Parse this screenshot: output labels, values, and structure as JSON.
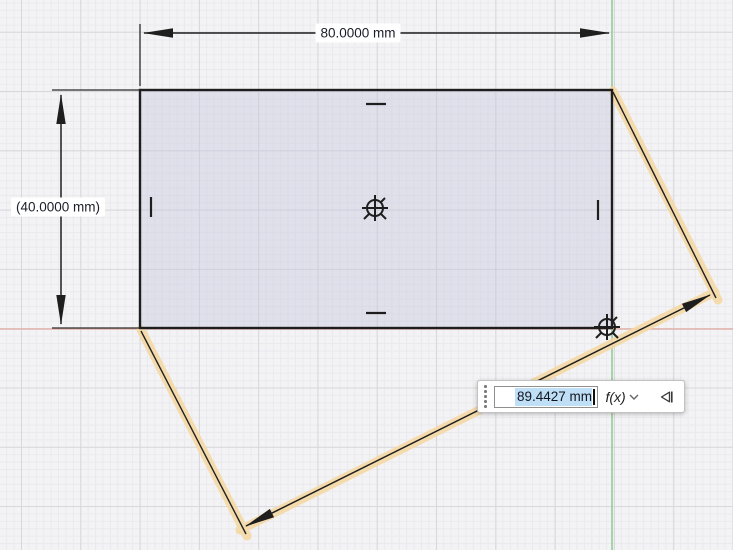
{
  "canvas": {
    "top_dimension_label": "80.0000 mm",
    "left_dimension_label": "(40.0000 mm)"
  },
  "dimension_input": {
    "value": "89.4427 mm",
    "fx_label": "f(x)"
  },
  "colors": {
    "x_axis_red": "#e4b3ac",
    "y_axis_green": "#95cb95",
    "sketch_line_black": "#1e1e1e",
    "profile_fill": "#e2e3ec",
    "selection_highlight_blue": "#bedff6",
    "dimension_glow_orange": "#f5d9a5",
    "grid_major": "#d7d7dc",
    "grid_minor": "#eaeaee"
  },
  "icons": {
    "drag_handle": "vertical-dots",
    "fx_dropdown_chevron": "chevron-down",
    "flip_direction": "left-triangle-with-bar",
    "center_point": "circle-crosshair",
    "origin_point": "circle-crosshair"
  }
}
